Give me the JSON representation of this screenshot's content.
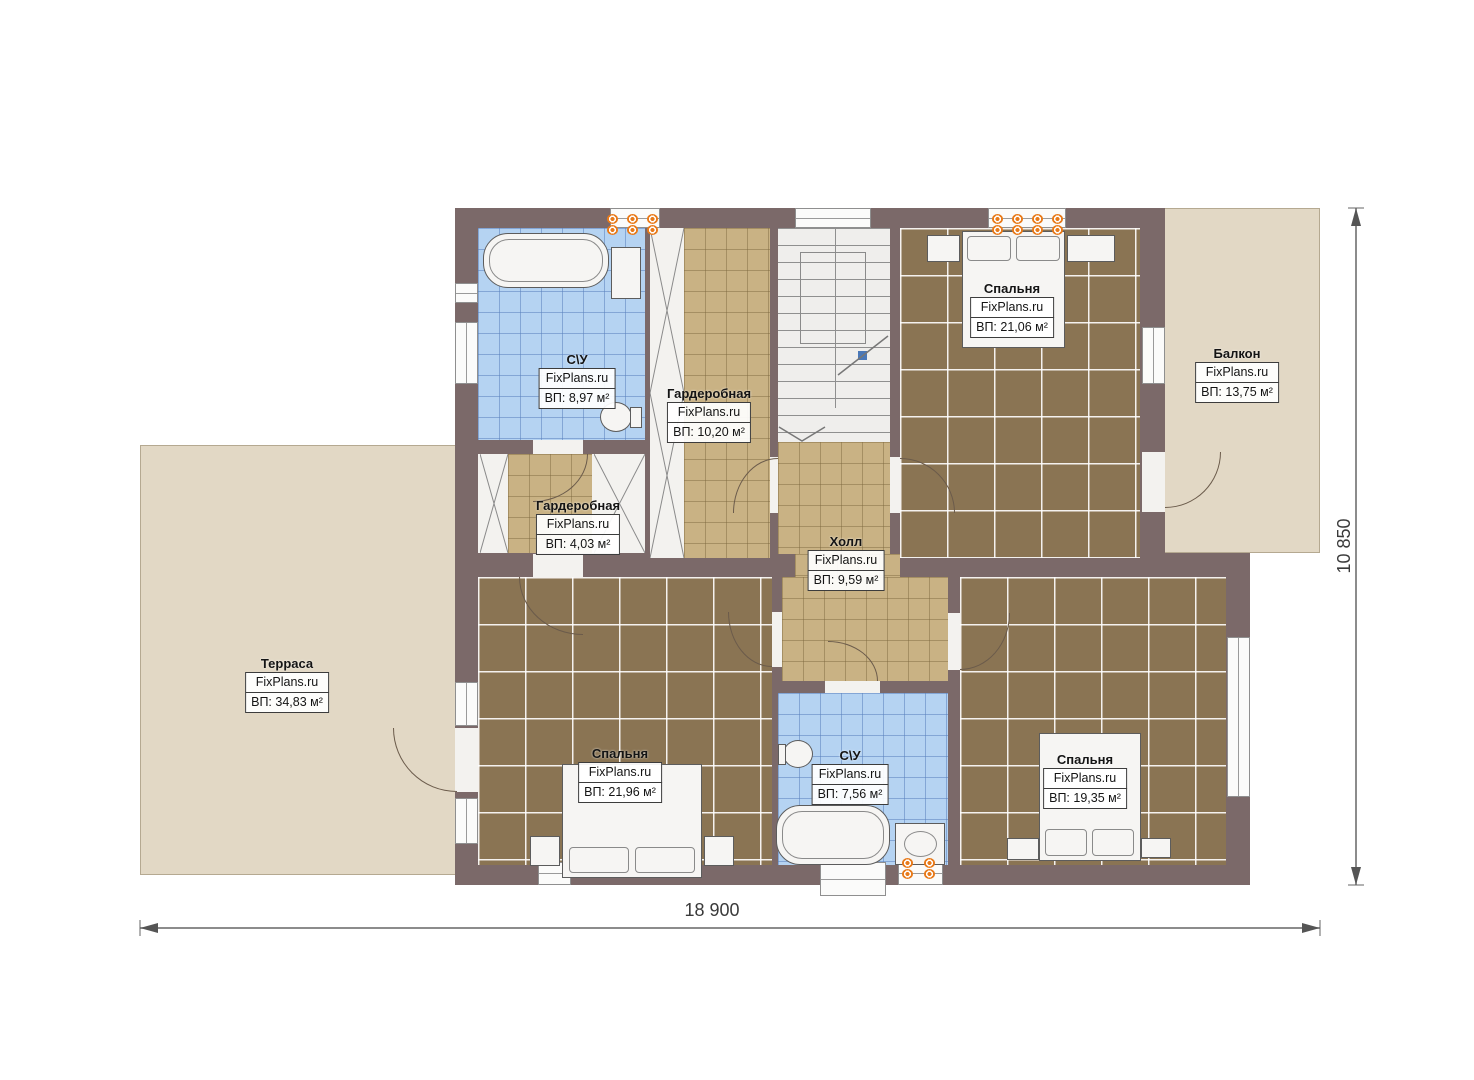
{
  "watermark": "FixPlans.ru",
  "rooms": {
    "bathroom_top": {
      "name": "С\\У",
      "area": "ВП: 8,97 м²"
    },
    "wardrobe_top": {
      "name": "Гардеробная",
      "area": "ВП: 10,20 м²"
    },
    "bedroom_top": {
      "name": "Спальня",
      "area": "ВП: 21,06 м²"
    },
    "balcony": {
      "name": "Балкон",
      "area": "ВП: 13,75 м²"
    },
    "wardrobe_small": {
      "name": "Гардеробная",
      "area": "ВП: 4,03 м²"
    },
    "hall": {
      "name": "Холл",
      "area": "ВП: 9,59 м²"
    },
    "terrace": {
      "name": "Терраса",
      "area": "ВП: 34,83 м²"
    },
    "bedroom_left": {
      "name": "Спальня",
      "area": "ВП: 21,96 м²"
    },
    "bathroom_bottom": {
      "name": "С\\У",
      "area": "ВП: 7,56 м²"
    },
    "bedroom_right": {
      "name": "Спальня",
      "area": "ВП: 19,35 м²"
    }
  },
  "dimensions": {
    "total_width": "18 900",
    "total_height": "10 850"
  },
  "colors": {
    "wall": "#7b6969",
    "outdoor_floor": "#e2d8c5",
    "carpet": "#8a7453",
    "tile_tan": "#c9b284",
    "tile_blue": "#b5d3f2",
    "radiator": "#e87a1a"
  }
}
